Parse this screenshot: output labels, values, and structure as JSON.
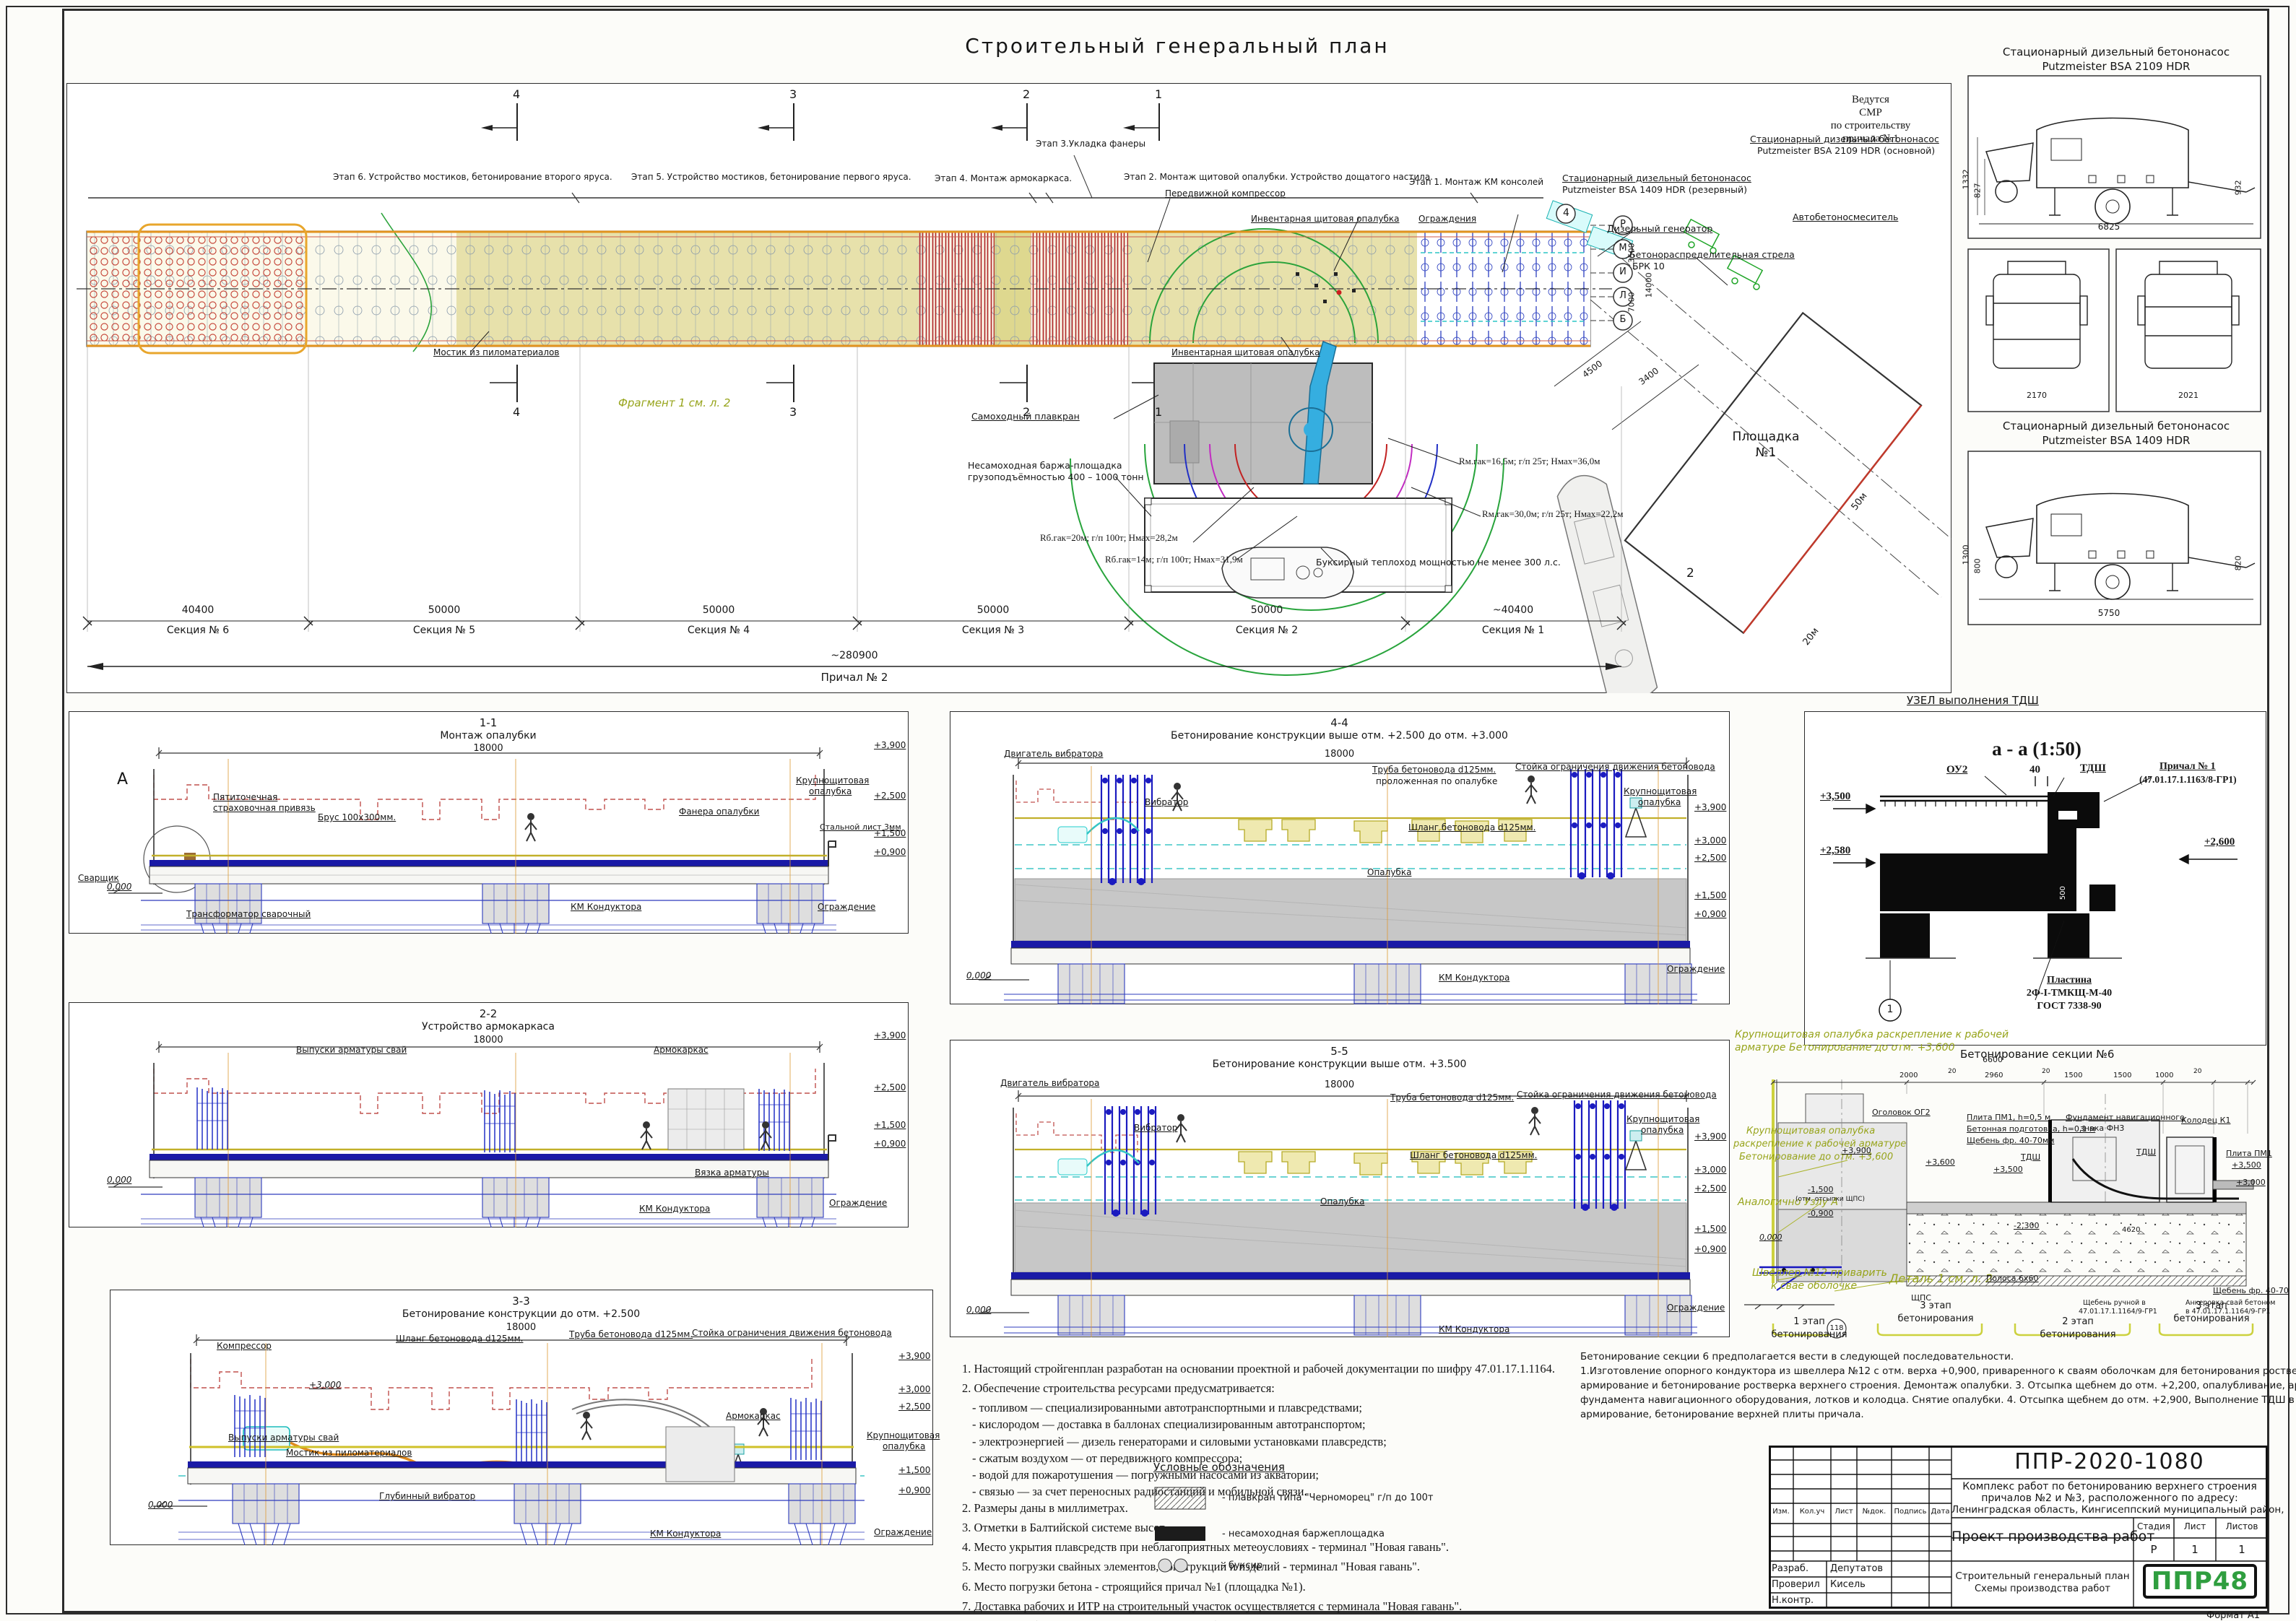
{
  "page": {
    "title": "Строительный генеральный план",
    "format": "Формат А1"
  },
  "plan": {
    "stages": [
      "Этап 6. Устройство мостиков, бетонирование второго яруса.",
      "Этап 5. Устройство мостиков, бетонирование первого яруса.",
      "Этап 4. Монтаж армокаркаса.",
      "Этап 3.Укладка фанеры",
      "Этап 2. Монтаж щитовой опалубки. Устройство дощатого настила.",
      "Этап 1. Монтаж КМ консолей"
    ],
    "cuts": [
      "4",
      "3",
      "2",
      "1"
    ],
    "axis": [
      "Р",
      "М",
      "И",
      "Л",
      "Б"
    ],
    "vdims": [
      "3500",
      "7000",
      "14000"
    ],
    "labels": {
      "compressor": "Передвижной компрессор",
      "formwork_top": "Инвентарная щитовая опалубка",
      "fence": "Ограждения",
      "formwork_bottom": "Инвентарная щитовая опалубка",
      "smr": [
        "Ведутся",
        "СМР",
        "по строительству",
        "причала №1"
      ],
      "pump_reserve1": "Стационарный дизельный бетононасос",
      "pump_reserve2": "Putzmeister BSA 1409 HDR (резервный)",
      "pump_main1": "Стационарный дизельный бетононасос",
      "pump_main2": "Putzmeister BSA 2109 HDR (основной)",
      "generator": "Дизельный генератор",
      "boom1": "Бетонораспределительная стрела",
      "boom2": "БРК 10",
      "mixer": "Автобетоносмеситель",
      "crane": "Самоходный плавкран",
      "barge1": "Несамоходная баржа-площадка",
      "barge2": "грузоподъёмностью 400 – 1000 тонн",
      "r1": "Rм.гак=16,5м; г/п 25т; Нмах=36,0м",
      "r2": "Rм.гак=30,0м; г/п 25т; Нмах=22,2м",
      "r3": "Rб.гак=20м; г/п 100т; Нмах=28,2м",
      "r4": "Rб.гак=14м; г/п 100т; Нмах=31,9м",
      "tug": "Буксирный теплоход мощностью не менее 300 л.с.",
      "bridge": "Мостик из пиломатериалов",
      "fragment": "Фрагмент 1 см. л. 2",
      "area1": "Площадка",
      "area2": "№1",
      "d4500": "4500",
      "d3400": "3400",
      "d50": "50м",
      "d20": "20м",
      "mark2": "2",
      "mark4": "4"
    },
    "dims": {
      "values": [
        "40400",
        "50000",
        "50000",
        "50000",
        "50000",
        "~40400"
      ],
      "names": [
        "Секция № 6",
        "Секция № 5",
        "Секция № 4",
        "Секция № 3",
        "Секция № 2",
        "Секция № 1"
      ],
      "total": "~280900",
      "total_name": "Причал № 2"
    }
  },
  "eq": {
    "t1a": "Стационарный дизельный бетононасос",
    "t1b": "Putzmeister BSA 2109 HDR",
    "e1": {
      "h1": "1332",
      "h2": "827",
      "l": "6825",
      "h3": "932"
    },
    "sd": [
      "2170",
      "2021"
    ],
    "t2a": "Стационарный дизельный бетононасос",
    "t2b": "Putzmeister BSA 1409 HDR",
    "e2": {
      "h1": "1300",
      "h2": "800",
      "l": "5750",
      "h3": "820"
    }
  },
  "s11": {
    "n": "1-1",
    "t": "Монтаж опалубки",
    "dim": "18000",
    "a": "А",
    "zero": "0,000",
    "l": {
      "strap1": "Пятиточечная",
      "strap2": "страховочная привязь",
      "brus": "Брус 100х300мм.",
      "fanera": "Фанера опалубки",
      "krupno1": "Крупнощитовая",
      "krupno2": "опалубка",
      "steel": "Стальной лист 3мм",
      "welder": "Сварщик",
      "transf": "Трансформатор сварочный",
      "km": "КМ Кондуктора",
      "fence": "Ограждение"
    },
    "e": [
      "+3,900",
      "+2,500",
      "+1,500",
      "+0,900"
    ]
  },
  "s22": {
    "n": "2-2",
    "t": "Устройство армокаркаса",
    "dim": "18000",
    "zero": "0,000",
    "l": {
      "vypuski": "Выпуски арматуры свай",
      "armo": "Армокаркас",
      "vyazka": "Вязка арматуры",
      "km": "КМ Кондуктора",
      "fence": "Ограждение"
    },
    "e": [
      "+3,900",
      "+2,500",
      "+1,500",
      "+0,900"
    ]
  },
  "s33": {
    "n": "3-3",
    "t": "Бетонирование конструкции до отм. +2.500",
    "dim": "18000",
    "zero": "0,000",
    "inner": "+3,000",
    "l": {
      "compressor": "Компрессор",
      "hose": "Шланг бетоновода d125мм.",
      "pipe": "Труба бетоновода d125мм.",
      "stand": "Стойка ограничения движения бетоновода",
      "vypuski": "Выпуски арматуры свай",
      "bridge": "Мостик из пиломатериалов",
      "armo": "Армокаркас",
      "krupno1": "Крупнощитовая",
      "krupno2": "опалубка",
      "vibro": "Глубинный вибратор",
      "km": "КМ Кондуктора",
      "fence": "Ограждение"
    },
    "e": [
      "+3,900",
      "+3,000",
      "+2,500",
      "+1,500",
      "+0,900"
    ]
  },
  "s44": {
    "n": "4-4",
    "t": "Бетонирование конструкции выше отм. +2.500 до отм. +3.000",
    "dim": "18000",
    "zero": "0,000",
    "l": {
      "motor": "Двигатель вибратора",
      "vibro": "Вибратор",
      "pipe1": "Труба бетоновода d125мм.",
      "pipe2": "проложенная по опалубке",
      "stand": "Стойка ограничения движения бетоновода",
      "krupno1": "Крупнощитовая",
      "krupno2": "опалубка",
      "hose": "Шланг бетоновода d125мм.",
      "opalubka": "Опалубка",
      "km": "КМ Кондуктора",
      "fence": "Ограждение"
    },
    "e": [
      "+3,900",
      "+3,000",
      "+2,500",
      "+1,500",
      "+0,900"
    ]
  },
  "s55": {
    "n": "5-5",
    "t": "Бетонирование конструкции выше отм. +3.500",
    "dim": "18000",
    "zero": "0,000",
    "l": {
      "motor": "Двигатель вибратора",
      "vibro": "Вибратор",
      "pipe": "Труба бетоновода d125мм.",
      "stand": "Стойка ограничения движения бетоновода",
      "krupno1": "Крупнощитовая",
      "krupno2": "опалубка",
      "hose": "Шланг бетоновода d125мм.",
      "opalubka": "Опалубка",
      "km": "КМ Кондуктора",
      "fence": "Ограждение"
    },
    "e": [
      "+3,900",
      "+3,000",
      "+2,500",
      "+1,500",
      "+0,900"
    ]
  },
  "node": {
    "title": "УЗЕЛ выполнения ТДШ",
    "scale": "а - а  (1:50)",
    "oy2": "ОУ2",
    "d40": "40",
    "tdsh": "ТДШ",
    "pr1": "Причал № 1",
    "pr2": "(47.01.17.1.1163/8-ГР1)",
    "e1": "+3,500",
    "e2": "+2,580",
    "e3": "+2,600",
    "v500": "500",
    "one": "1",
    "pl1": "Пластина",
    "pl2": "2Ф-I-ТМКЩ-М-40",
    "pl3": "ГОСТ 7338-90",
    "caption": "Бетонирование секции №6"
  },
  "d6": {
    "g1a": "Крупнощитовая опалубка раскрепление к рабочей",
    "g1b": "арматуре Бетонирование до отм. +3,600",
    "g2a": "Крупнощитовая опалубка",
    "g2b": "раскрепление к рабочей арматуре",
    "g2c": "Бетонирование до отм. +3,600",
    "g3": "Аналогично Узлу А",
    "g4a": "Швеллер №12 приварить",
    "g4b": "к свае оболочке",
    "g5": "Деталь 1 см. л. 2",
    "dims": {
      "d6600": "6600",
      "d2000": "2000",
      "d2960": "2960",
      "d1500a": "1500",
      "d1500b": "1500",
      "d1000": "1000",
      "d20a": "20",
      "d20b": "20",
      "d20c": "20",
      "d4620": "4620"
    },
    "l": {
      "ogolovok": "Оголовок ОГ2",
      "plita": "Плита ПМ1, h=0,5 м",
      "podgotovka": "Бетонная подготовка, h=0,1 м",
      "scheben": "Щебень фр. 40-70мм",
      "fund1": "Фундамент навигационного",
      "fund2": "знака ФН3",
      "kolodets": "Колодец К1",
      "tdsh1": "ТДШ",
      "tdsh2": "ТДШ",
      "plita2": "Плита ПМ1",
      "polosa": "Полоса 6х60",
      "shps": "ЩПС",
      "scheben2": "Щебень фр. 40-70",
      "anchor1": "Анкеровка свай бетоном",
      "anchor2": "в 47.01.17.1.1164/9-ГР1",
      "gravel1": "Щебень ручной в",
      "gravel2": "47.01.17.1.1164/9-ГР1",
      "n118": "118"
    },
    "e": {
      "e39": "+3,900",
      "e36": "+3,600",
      "e35": "+3,500",
      "er35": "+3,500",
      "er30": "+3,000",
      "em23": "-2,300",
      "em15": "-1,500",
      "em15b": "(отм. отсыпки ЩПС)",
      "em09": "-0,900",
      "zero": "0,000"
    },
    "stages": [
      {
        "a": "1 этап",
        "b": "бетонирования"
      },
      {
        "a": "3 этап",
        "b": "бетонирования"
      },
      {
        "a": "2 этап",
        "b": "бетонирования"
      },
      {
        "a": "3 этап",
        "b": "бетонирования"
      }
    ]
  },
  "seq": [
    "Бетонирование секции 6 предполагается вести в следующей последовательности.",
    "1.Изготовление опорного кондуктора из швеллера №12 с отм. верха +0,900, приваренного к сваям оболочкам для бетонирования ростверка. 2. Опалубливание,",
    "армирование и бетонирование ростверка верхнего строения. Демонтаж опалубки. 3. Отсыпка щебнем до отм. +2,200, опалубливание, армирование, бетонирование",
    "фундамента навигационного оборудования, лотков и колодца. Снятие опалубки. 4. Отсыпка щебнем до отм. +2,900, Выполнение ТДШ в проектных местах,",
    "армирование, бетонирование верхней плиты причала."
  ],
  "notes": [
    "1. Настоящий стройгенплан разработан на основании проектной и рабочей документации по шифру 47.01.17.1.1164.",
    "2. Обеспечение строительства ресурсами предусматривается:",
    "- топливом — специализированными автотранспортными и  плавсредствами;",
    "- кислородом — доставка в баллонах специализированным автотранспортом;",
    "- электроэнергией — дизель генераторами и силовыми установками плавсредств;",
    "- сжатым воздухом — от передвижного компрессора;",
    "- водой для пожаротушения — погружными насосами из акватории;",
    "- связью — за счет переносных радиостанций и мобильной связи.",
    "2. Размеры даны в миллиметрах.",
    "3.  Отметки в Балтийской системе высот.",
    "4. Место укрытия плавсредств при неблагоприятных метеоусловиях - терминал \"Новая гавань\".",
    "5.  Место погрузки свайных элементов, конструкций и изделий - терминал \"Новая гавань\".",
    "6. Место погрузки бетона - строящийся причал №1 (площадка №1).",
    "7. Доставка рабочих и ИТР на строительный участок осуществляется с терминала \"Новая гавань\".",
    "8. Машины, оборудование и плавсредства могут быть заменены на аналогичные по техническим характеристикам."
  ],
  "legend": {
    "title": "Условные обозначения",
    "i1": "-   плавкран типа \"Черноморец\" г/п до 100т",
    "i2": "-   несамоходная баржеплощадка",
    "i3": "-   буксир"
  },
  "tb": {
    "code": "ППР-2020-1080",
    "d1": "Комплекс работ по бетонированию верхнего строения",
    "d2": "причалов №2 и №3, расположенного по адресу:",
    "d3": "Ленинградская область, Кингисеппский муниципальный район,",
    "doc": "Проект производства работ",
    "h": [
      "Изм.",
      "Кол.уч",
      "Лист",
      "№док.",
      "Подпись",
      "Дата"
    ],
    "sh": [
      "Стадия",
      "Лист",
      "Листов"
    ],
    "sv": [
      "Р",
      "1",
      "1"
    ],
    "r1": "Разраб.",
    "r1v": "Депутатов",
    "r2": "Проверил",
    "r2v": "Кисель",
    "r3": "Н.контр.",
    "st1": "Строительный генеральный план",
    "st2": "Схемы производства работ",
    "logo": "ППР48"
  }
}
